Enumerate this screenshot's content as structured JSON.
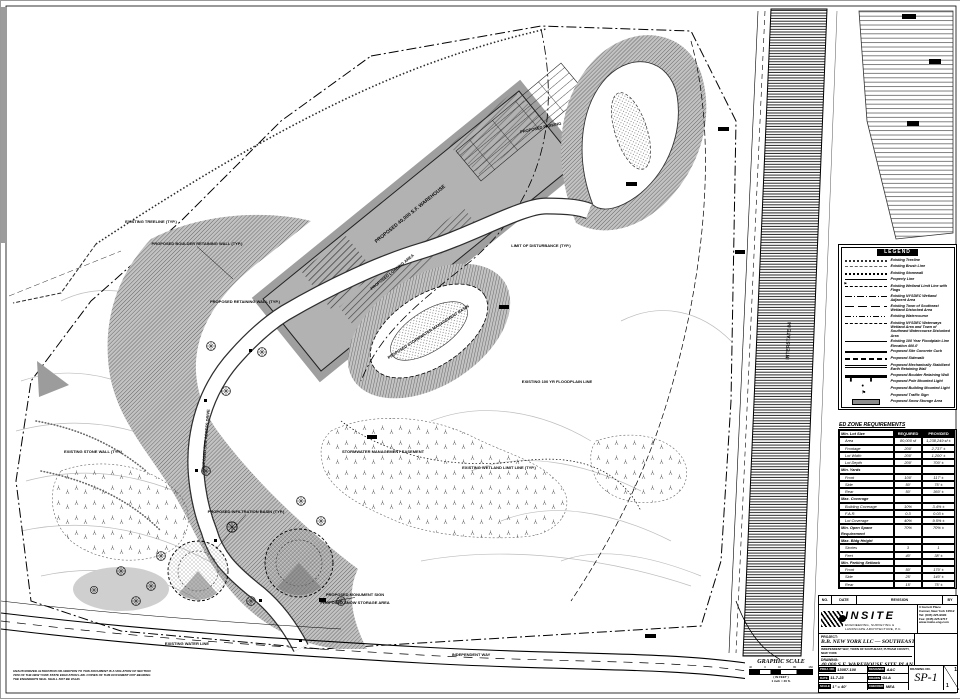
{
  "legend": {
    "title": "LEGEND",
    "items": [
      {
        "style": "treeline",
        "label": "Existing Treeline"
      },
      {
        "style": "brushline",
        "label": "Existing Brush Line"
      },
      {
        "style": "stonewall",
        "label": "Existing Stonewall"
      },
      {
        "style": "property",
        "label": "Property Line"
      },
      {
        "style": "wetflag",
        "label": "Existing Wetland Limit Line with Flags"
      },
      {
        "style": "adjacent",
        "label": "Existing NYSDEC Wetland Adjacent Area"
      },
      {
        "style": "tos-wetland",
        "label": "Existing Town of Southeast Wetland Disturbed Area"
      },
      {
        "style": "watercourse",
        "label": "Existing Watercourse"
      },
      {
        "style": "nysdec",
        "label": "Existing NYSDEC Waterways Wetland Area and Town of Southeast Watercourse Disturbed Area"
      },
      {
        "style": "floodplain",
        "label": "Existing 100 Year Floodplain Line Elevation 400.0'"
      },
      {
        "style": "curb",
        "label": "Proposed Site Concrete Curb"
      },
      {
        "style": "sidewalk",
        "label": "Proposed Sidewalk"
      },
      {
        "style": "msewall",
        "label": "Proposed Mechanically Stabilized Earth Retaining Wall"
      },
      {
        "style": "boulderwall",
        "label": "Proposed Boulder Retaining Wall"
      },
      {
        "style": "polelight",
        "label": "Proposed Pole Mounted Light"
      },
      {
        "style": "bldglight",
        "label": "Proposed Building Mounted Light"
      },
      {
        "style": "trafficsign",
        "label": "Proposed Traffic Sign"
      },
      {
        "style": "snow",
        "label": "Proposed Snow Storage Area"
      }
    ]
  },
  "zone_table": {
    "title": "ED ZONE REQUIREMENTS",
    "rows": [
      {
        "type": "header",
        "name": "Min. Lot Size",
        "req": "REQUIRED",
        "prov": "PROVIDED"
      },
      {
        "type": "item",
        "name": "Area",
        "req": "80,000 sf",
        "prov": "1,238,249 sf ±"
      },
      {
        "type": "item",
        "name": "Frontage",
        "req": "200'",
        "prov": "2,737' ±"
      },
      {
        "type": "item",
        "name": "Lot Width",
        "req": "200'",
        "prov": "1,200' ±"
      },
      {
        "type": "item",
        "name": "Lot Depth",
        "req": "200'",
        "prov": "700' ±"
      },
      {
        "type": "section",
        "name": "Min. Yards",
        "req": "",
        "prov": ""
      },
      {
        "type": "item",
        "name": "Front",
        "req": "100'",
        "prov": "117' ±"
      },
      {
        "type": "item",
        "name": "Side",
        "req": "50'",
        "prov": "75' ±"
      },
      {
        "type": "item",
        "name": "Rear",
        "req": "50'",
        "prov": "360' ±"
      },
      {
        "type": "section",
        "name": "Max. Coverage",
        "req": "",
        "prov": ""
      },
      {
        "type": "item",
        "name": "Building Coverage",
        "req": "10%",
        "prov": "3.4% ±"
      },
      {
        "type": "item",
        "name": "F.A.R.",
        "req": "0.3",
        "prov": "0.03 ±"
      },
      {
        "type": "item",
        "name": "Lot Coverage",
        "req": "40%",
        "prov": "9.5% ±"
      },
      {
        "type": "item0",
        "name": "Min. Open Space Requirement",
        "req": "70%",
        "prov": "70% ±"
      },
      {
        "type": "section",
        "name": "Max. Bldg Height",
        "req": "",
        "prov": ""
      },
      {
        "type": "item",
        "name": "Stories",
        "req": "3",
        "prov": "1"
      },
      {
        "type": "item",
        "name": "Feet",
        "req": "40'",
        "prov": "38' ±"
      },
      {
        "type": "section",
        "name": "Min. Parking Setback",
        "req": "",
        "prov": ""
      },
      {
        "type": "item",
        "name": "Front",
        "req": "50'",
        "prov": "170' ±"
      },
      {
        "type": "item",
        "name": "Side",
        "req": "25'",
        "prov": "140' ±"
      },
      {
        "type": "item",
        "name": "Rear",
        "req": "15'",
        "prov": "75' ±"
      }
    ]
  },
  "titleblock": {
    "rev": {
      "no": "NO.",
      "date": "DATE",
      "revision": "REVISION",
      "by": "BY"
    },
    "firm": {
      "name": "INSITE",
      "tagline1": "ENGINEERING, SURVEYING &",
      "tagline2": "LANDSCAPE ARCHITECTURE, P.C.",
      "addr1": "3 Garrett Place",
      "addr2": "Carmel, New York 10512",
      "addr3": "Tel: (845) 225-9690",
      "addr4": "Fax: (845) 225-9717",
      "addr5": "www.insite-eng.com"
    },
    "project_label": "PROJECT:",
    "project_name": "B.B. NEW YORK LLC — SOUTHEAST",
    "project_location": "INDEPENDENT WAY, TOWN OF SOUTHEAST, PUTNAM COUNTY, NEW YORK",
    "drawing_label": "DRAWING:",
    "drawing_name": "40,000 S.F. WAREHOUSE SITE PLAN",
    "fields": {
      "proj_no_label": "PROJ. NO.",
      "proj_no": "13087.100",
      "date_label": "DATE",
      "date": "11-7-23",
      "scale_label": "SCALE",
      "scale": "1\" = 40'",
      "designed_label": "DESIGNED",
      "designed": "AAC",
      "drawn_label": "DRAWN",
      "drawn": "GLA",
      "checked_label": "CHECKED",
      "checked": "MEA",
      "drawing_no_label": "DRAWING NO.",
      "drawing_no": "SP-1",
      "sheet_top": "1",
      "sheet_bottom": "1"
    }
  },
  "graphic_scale": {
    "title": "GRAPHIC SCALE",
    "ticks": [
      "40",
      "0",
      "40",
      "80",
      "160"
    ],
    "in_feet": "( IN FEET )",
    "ratio": "1 inch = 40 ft."
  },
  "corner_note": {
    "line1": "UNAUTHORIZED ALTERATION OR ADDITION TO THIS DOCUMENT IS A VIOLATION OF SECTION",
    "line2": "7209 OF THE NEW YORK STATE EDUCATION LAW. COPIES OF THIS DOCUMENT NOT BEARING",
    "line3": "THE ENGINEER'S SEAL SHALL NOT BE VALID."
  },
  "plan_labels": [
    {
      "text": "PROPOSED BOULDER RETAINING WALL (TYP.)",
      "x": 196,
      "y": 244,
      "lx": 232,
      "ly": 278
    },
    {
      "text": "PROPOSED 40,000 S.F. WAREHOUSE",
      "x": 410,
      "y": 214,
      "rot": -39,
      "fs": 5
    },
    {
      "text": "PROPOSED LOADING AREA",
      "x": 392,
      "y": 272,
      "rot": -39
    },
    {
      "text": "PROPOSED STORMWATER MANAGEMENT BASIN",
      "x": 428,
      "y": 332,
      "rot": -33
    },
    {
      "text": "STORMWATER MANAGEMENT EASEMENT",
      "x": 382,
      "y": 452
    },
    {
      "text": "PROPOSED INFILTRATION BASIN (TYP.)",
      "x": 245,
      "y": 512,
      "lx": 215,
      "ly": 548
    },
    {
      "text": "PROPOSED MONUMENT SIGN",
      "x": 354,
      "y": 595,
      "lx": 322,
      "ly": 602
    },
    {
      "text": "PROPOSED SNOW STORAGE AREA",
      "x": 354,
      "y": 603
    },
    {
      "text": "EXISTING WATER LINE",
      "x": 186,
      "y": 644
    },
    {
      "text": "PROPOSED SITE ACCESS DRIVE",
      "x": 206,
      "y": 440,
      "rot": -85
    },
    {
      "text": "EXISTING WETLAND LIMIT LINE (TYP.)",
      "x": 498,
      "y": 468
    },
    {
      "text": "EXISTING 100 YR FLOODPLAIN LINE",
      "x": 556,
      "y": 382
    },
    {
      "text": "LIMIT OF DISTURBANCE (TYP.)",
      "x": 540,
      "y": 246
    },
    {
      "text": "EXISTING TREELINE (TYP.)",
      "x": 150,
      "y": 222
    },
    {
      "text": "INTERSTATE 84",
      "x": 789,
      "y": 340,
      "rot": -87,
      "fs": 5
    },
    {
      "text": "INDEPENDENT WAY",
      "x": 470,
      "y": 655
    },
    {
      "text": "EXISTING STONE WALL (TYP.)",
      "x": 92,
      "y": 452
    },
    {
      "text": "PROPOSED RETAINING WALL (TYP.)",
      "x": 244,
      "y": 302
    },
    {
      "text": "PROPOSED PARKING",
      "x": 540,
      "y": 128,
      "rot": -12
    }
  ]
}
